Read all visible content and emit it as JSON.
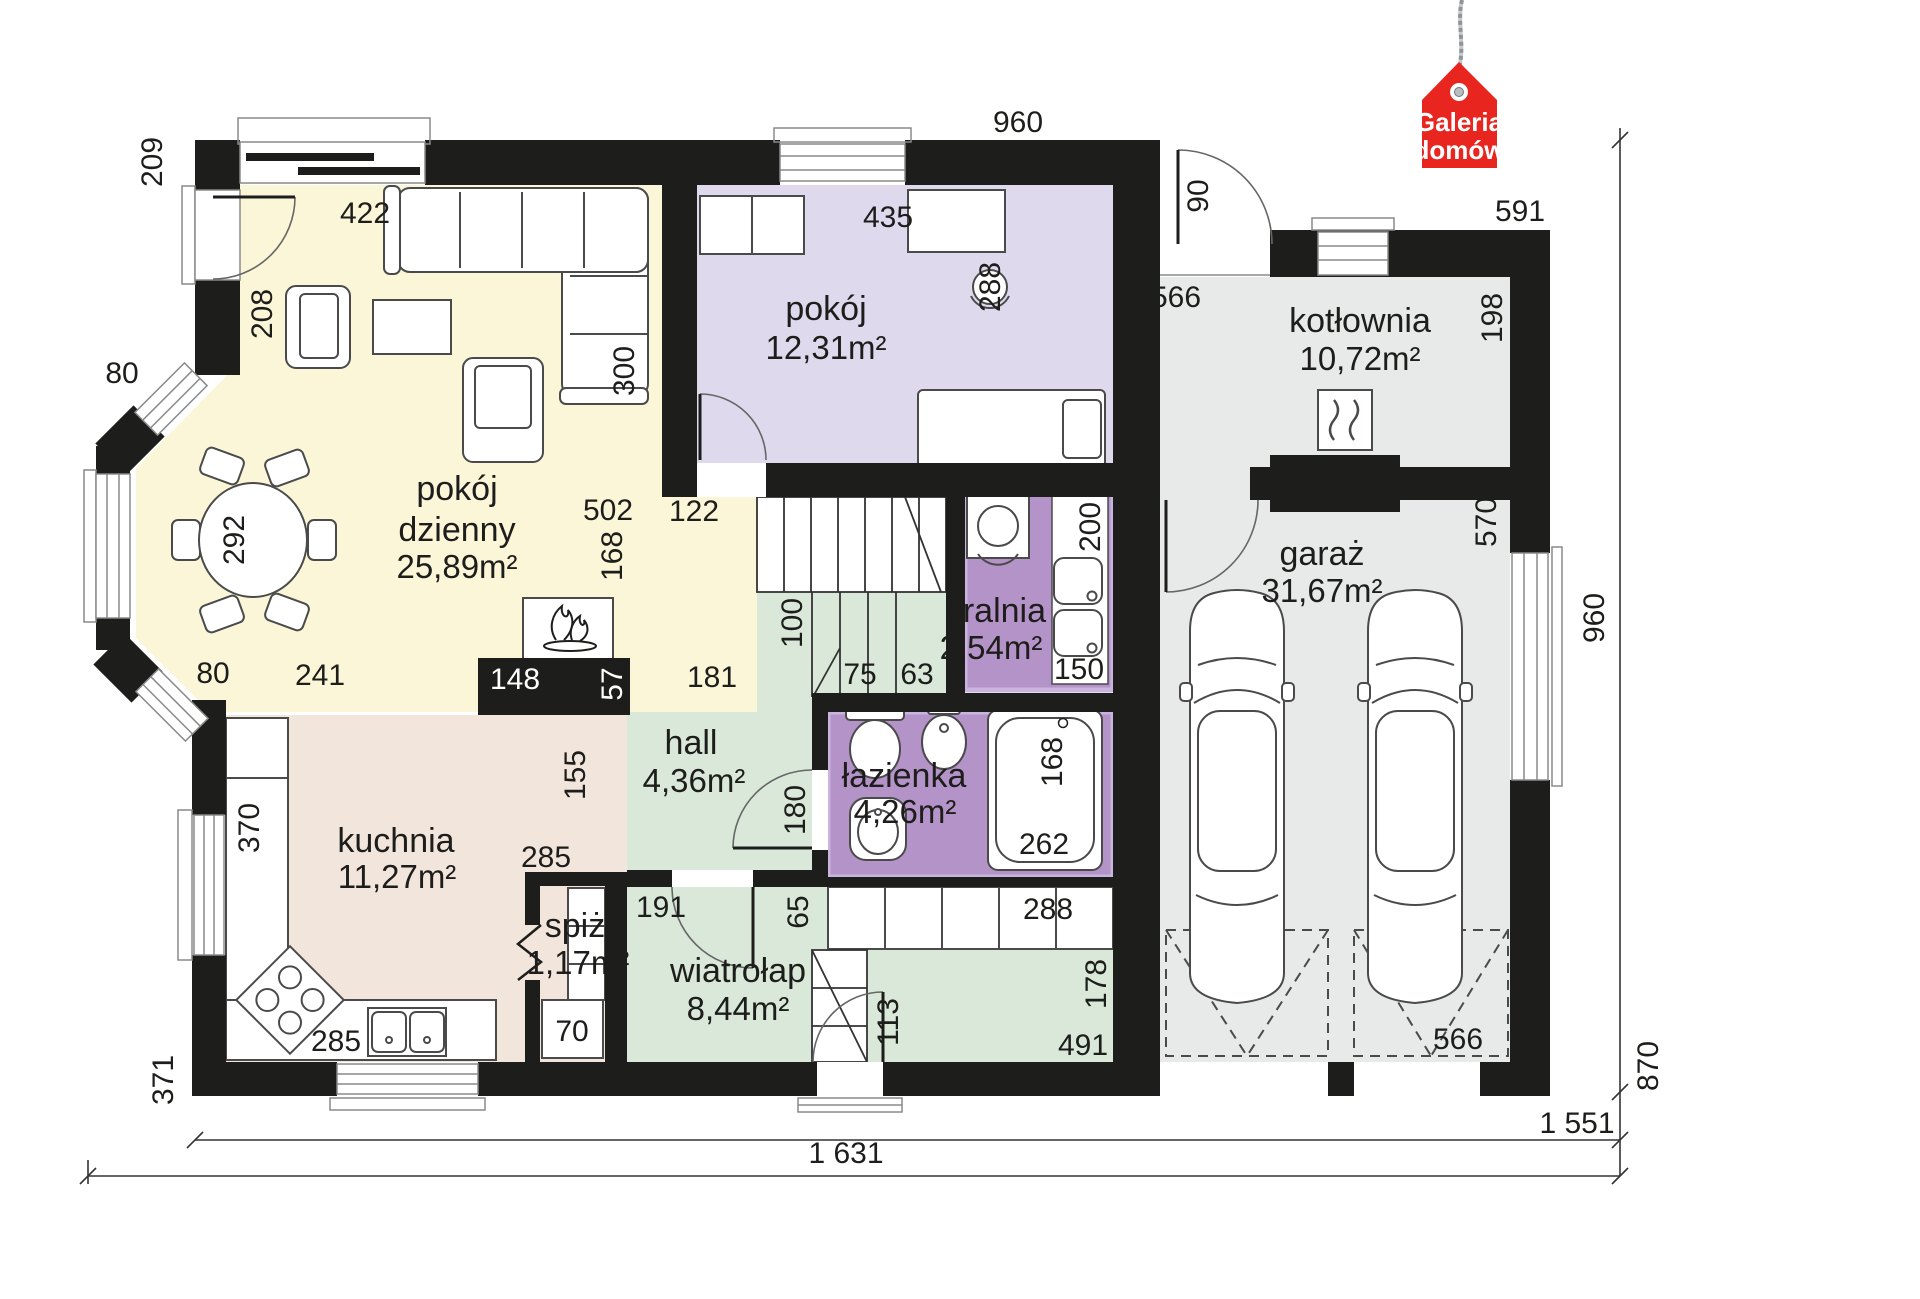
{
  "logo": {
    "line1": "Galeria",
    "line2": "domów"
  },
  "palette": {
    "wall": "#1d1d1b",
    "living_yellow": "#fbf6d8",
    "room_lavender": "#ded9ec",
    "bath_purple": "#b493c8",
    "purple_frame": "#c9b4dd",
    "hall_green": "#d9e8d9",
    "kitchen_beige": "#f2e5dc",
    "garage_gray": "#e8e9e9",
    "logo_red": "#e8251f"
  },
  "rooms": {
    "pokoj_dzienny": {
      "name": "pokój",
      "name2": "dzienny",
      "area": "25,89m²"
    },
    "pokoj": {
      "name": "pokój",
      "area": "12,31m²"
    },
    "kotlownia": {
      "name": "kotłownia",
      "area": "10,72m²"
    },
    "garaz": {
      "name": "garaż",
      "area": "31,67m²"
    },
    "pralnia": {
      "name": "pralnia",
      "area": "2,54m²"
    },
    "lazienka": {
      "name": "łazienka",
      "area": "4,26m²"
    },
    "hall": {
      "name": "hall",
      "area": "4,36m²"
    },
    "kuchnia": {
      "name": "kuchnia",
      "area": "11,27m²"
    },
    "spiz": {
      "name": "spiż",
      "area": "1,17m²"
    },
    "wiatrolap": {
      "name": "wiatrołap",
      "area": "8,44m²"
    }
  },
  "dims": {
    "d209": "209",
    "d422": "422",
    "d80a": "80",
    "d208": "208",
    "d292": "292",
    "d80b": "80",
    "d241": "241",
    "d502": "502",
    "d168a": "168",
    "d148": "148",
    "d57": "57",
    "d181": "181",
    "d122": "122",
    "d300": "300",
    "d435": "435",
    "d288a": "288",
    "d960t": "960",
    "d90": "90",
    "d566t": "566",
    "d591": "591",
    "d198": "198",
    "d570": "570",
    "d960r": "960",
    "d100": "100",
    "d75": "75",
    "d63": "63",
    "d200": "200",
    "d150": "150",
    "d155": "155",
    "d180": "180",
    "d168b": "168",
    "d262": "262",
    "d370": "370",
    "d285a": "285",
    "d285b": "285",
    "d70": "70",
    "d191": "191",
    "d65": "65",
    "d288b": "288",
    "d178": "178",
    "d113": "113",
    "d491": "491",
    "d371": "371",
    "d566b": "566",
    "d870": "870",
    "d1551": "1 551",
    "d1631": "1 631"
  }
}
